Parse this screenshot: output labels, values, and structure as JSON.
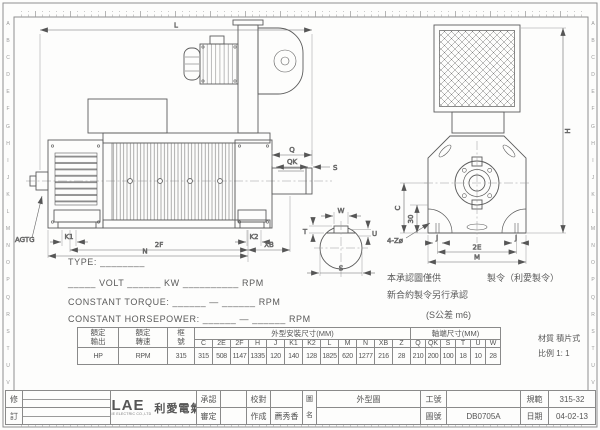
{
  "frame": {
    "side_letters": [
      "A",
      "B",
      "C",
      "D",
      "E",
      "F",
      "G",
      "H",
      "I",
      "J",
      "K",
      "L",
      "M",
      "N",
      "O",
      "P",
      "Q",
      "R",
      "S",
      "T",
      "U",
      "V"
    ]
  },
  "drawing": {
    "L": "L",
    "Q": "Q",
    "QK": "QK",
    "S": "S",
    "AGTG": "AGTG",
    "K1": "K1",
    "K2": "K2",
    "2F": "2F",
    "XB": "XB",
    "N": "N",
    "H": "H",
    "C": "C",
    "d30": "30",
    "holes": "4-Zø",
    "J1": "J",
    "J2": "J",
    "2E": "2E",
    "M": "M",
    "W": "W",
    "T": "T",
    "U": "U",
    "S2": "S"
  },
  "spec": {
    "type_line": "TYPE: ________",
    "power_line": "_____ VOLT ______ KW __________ RPM",
    "torque_line": "CONSTANT TORQUE: ______ — ______ RPM",
    "horsepower_line": "CONSTANT HORSEPOWER: ______ — ______ RPM"
  },
  "notes": {
    "note1_left": "本承認圖僅供",
    "note1_right": "製令（利愛製令）",
    "note2": "新合約製令另行承認",
    "tolerance": "(S公差 m6)"
  },
  "table": {
    "rated_output": [
      "額定",
      "輸出"
    ],
    "rated_speed": [
      "額定",
      "轉速"
    ],
    "frame_no": [
      "框",
      "號"
    ],
    "dims_group": "外型安裝尺寸(MM)",
    "shaft_group": "軸端尺寸(MM)",
    "columns": [
      "C",
      "2E",
      "2F",
      "H",
      "J",
      "K1",
      "K2",
      "L",
      "M",
      "N",
      "XB",
      "Z",
      "Q",
      "QK",
      "S",
      "T",
      "U",
      "W"
    ],
    "output_unit": "HP",
    "speed_unit": "RPM",
    "frame_value": "315",
    "values": [
      "315",
      "508",
      "1147",
      "1335",
      "120",
      "140",
      "128",
      "1825",
      "620",
      "1277",
      "216",
      "28",
      "210",
      "200",
      "100",
      "18",
      "10",
      "28"
    ]
  },
  "material": {
    "label": "材質",
    "value": "積片式",
    "scale_label": "比例",
    "scale_value": "1: 1"
  },
  "title_block": {
    "rev_top": "修",
    "rev_bottom": "訂",
    "logo_text": "LAE",
    "logo_sub": "LI AIE ELECTRIC CO.,LTD",
    "logo_cn": "利愛電氣",
    "approve": "承認",
    "review": "審定",
    "check": "校對",
    "made": "作成",
    "made_by": "薦秀香",
    "name_l1": "圖",
    "name_l2": "名",
    "drawing_name": "外型圖",
    "job_label": "工號",
    "job_value": "",
    "dwg_label": "圖號",
    "dwg_value": "DB0705A",
    "spec_label": "規範",
    "spec_value": "315-32",
    "date_label": "日期",
    "date_value": "04-02-13"
  }
}
